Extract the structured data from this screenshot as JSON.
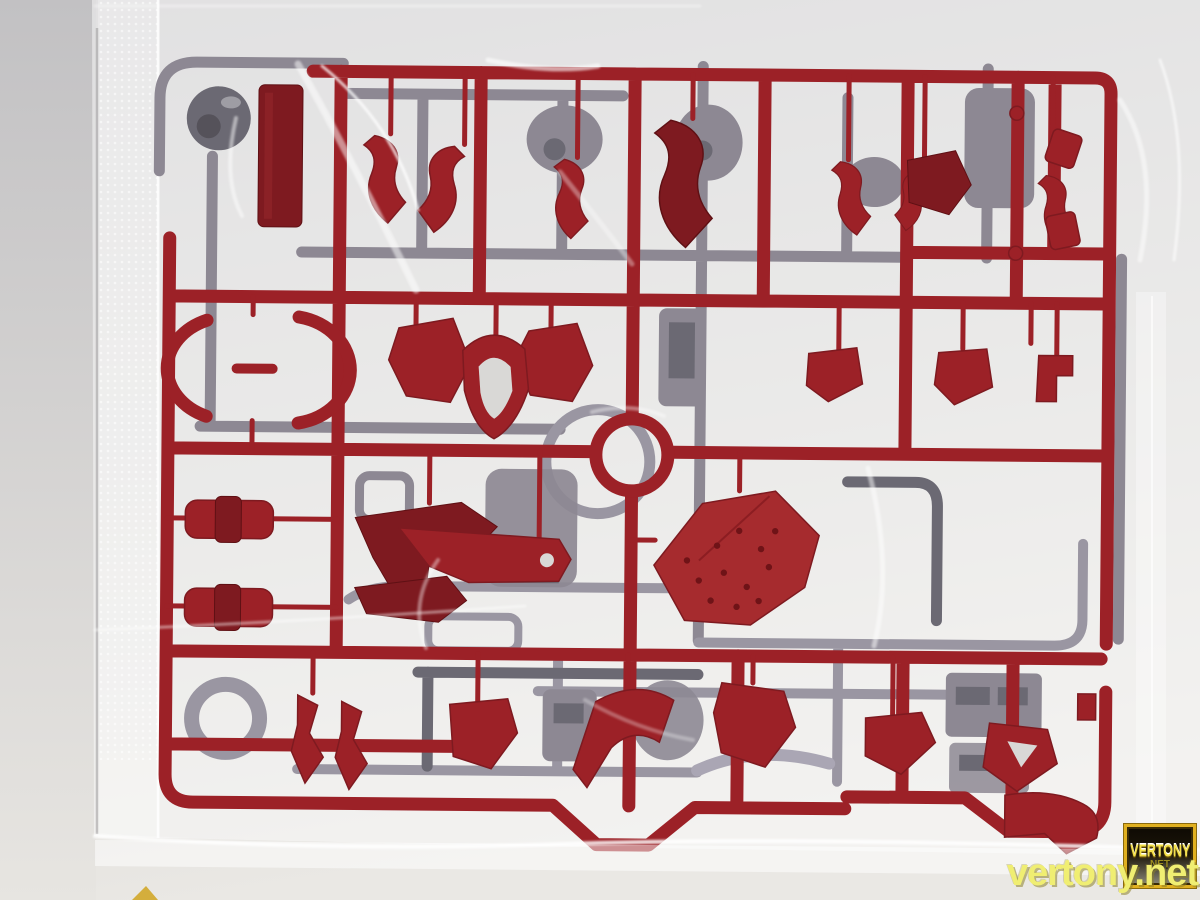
{
  "scene": {
    "subject": "Model kit runner (sprue) with dark red and gray plastic parts sealed in a clear plastic bag",
    "setting": "Photographed lying on a light gray surface; bag seam on the left, crinkle highlights across the plastic"
  },
  "watermark": {
    "text": "vertony.net",
    "badge_title": "VERTONY",
    "badge_subtitle": "NET"
  },
  "colors": {
    "red-runner": "#9c2127",
    "red-dark": "#7e1a20",
    "red-bright": "#a62b2e",
    "gray-part": "#8d8893",
    "gray-dark": "#6b6973",
    "gray-light": "#9a96a2",
    "lavender": "#aaa6b4",
    "bg-top": "#c7c6c8",
    "bg-mid": "#d9d8d6",
    "bg-bottom": "#eae8e4",
    "bag-white": "#ffffff",
    "watermark-yellow": "#f0ee72",
    "badge-gold": "#e0b020",
    "badge-bg": "#120d05",
    "badge-net": "#9c8c20"
  }
}
